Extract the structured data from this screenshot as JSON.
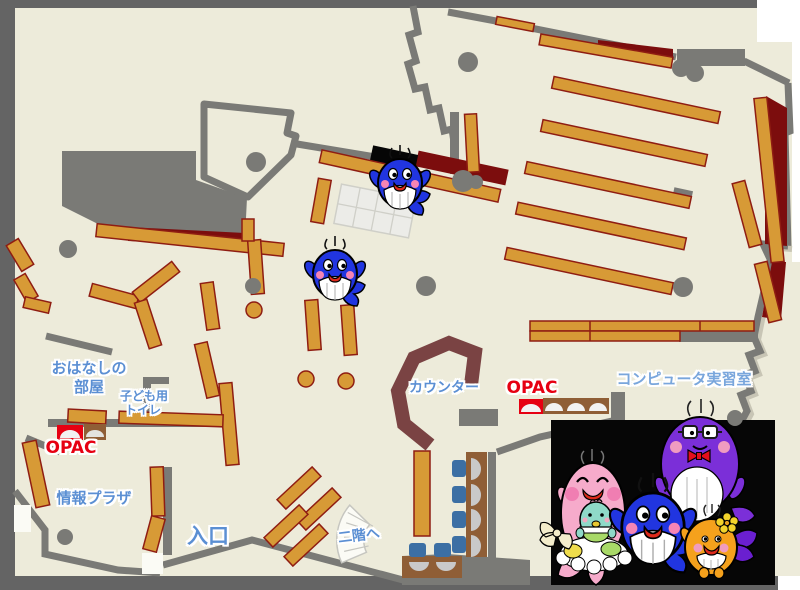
{
  "map": {
    "rooms": {
      "storytelling_room_line1": "おはなしの",
      "storytelling_room_line2": "部屋",
      "kids_toilet_line1": "子ども用",
      "kids_toilet_line2": "トイレ",
      "opac_left": "OPAC",
      "opac_right": "OPAC",
      "info_plaza": "情報プラザ",
      "entrance": "入口",
      "counter": "カウンター",
      "computer_room": "コンピュータ実習室",
      "to_second_floor": "二階へ"
    },
    "icons": [
      "whale-mascot-icon",
      "whale-family-photo",
      "bookshelf",
      "pillar",
      "staircase",
      "opac-terminal",
      "reading-table-grid",
      "counter-desk",
      "computer-desk"
    ],
    "palette": {
      "floor": "#EDEBDA",
      "frame": "#646464",
      "wall": "#7A7A76",
      "shelf": "#D79A36",
      "shelf-line": "#8F1D12",
      "dark-red": "#7C0D0D",
      "counter": "#7A4343",
      "desk": "#8F5E36",
      "chair": "#3C6FA4",
      "screen": "#C9C9C9",
      "door": "#FBFBF5",
      "grid-l": "#CFCFC8",
      "grid-f": "#ECECE8",
      "label-blue": "#5B8FD3",
      "label-blue-light": "#79A6DC",
      "label-red": "#E60012",
      "panel-black": "#060606",
      "whale-blue": "#2135E0",
      "pink": "#F6ABCB",
      "purple": "#7B2FD8",
      "orange-m": "#F5A11C",
      "teal": "#8FD9C8",
      "flower": "#F2D32B",
      "tail-purple": "#6A1FD0",
      "bow": "#F3ECCB",
      "mouth": "#DD2A1B",
      "cheek": "#F585B5"
    }
  }
}
